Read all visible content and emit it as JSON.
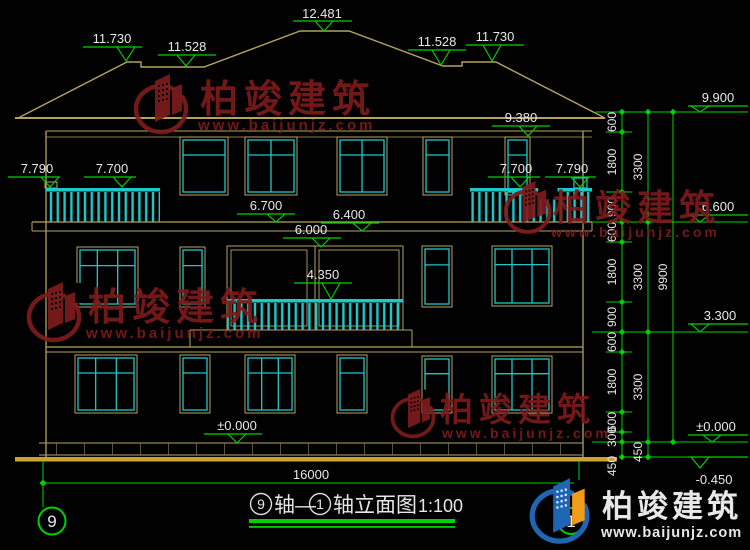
{
  "watermark": {
    "brand": "柏竣建筑",
    "url": "www.baijunjz.com"
  },
  "logo": {
    "brand": "柏竣建筑",
    "url": "www.baijunjz.com"
  },
  "title": {
    "axis_start": "9",
    "segment1": "轴—",
    "axis_end": "1",
    "segment2": "轴立面图",
    "scale": "1:100"
  },
  "axis_bubbles": {
    "left": "9",
    "right": "1"
  },
  "bottom_dimension": {
    "total_width": "16000"
  },
  "elevation_markers": [
    {
      "id": "ridge-main",
      "label": "12.481"
    },
    {
      "id": "ridge-left-high",
      "label": "11.730"
    },
    {
      "id": "ridge-left-low",
      "label": "11.528"
    },
    {
      "id": "ridge-right-low",
      "label": "11.528"
    },
    {
      "id": "ridge-right-high",
      "label": "11.730"
    },
    {
      "id": "eave-fascia",
      "label": "9.380"
    },
    {
      "id": "right-chain-top",
      "label": "9.900"
    },
    {
      "id": "balcony3f-left-post",
      "label": "7.790"
    },
    {
      "id": "balcony3f-left-rail",
      "label": "7.700"
    },
    {
      "id": "balcony3f-right-rail",
      "label": "7.700"
    },
    {
      "id": "balcony3f-right-post",
      "label": "7.790"
    },
    {
      "id": "cornice-left",
      "label": "6.700"
    },
    {
      "id": "cornice-mid",
      "label": "6.400"
    },
    {
      "id": "floor-3f",
      "label": "6.000"
    },
    {
      "id": "right-chain-mid",
      "label": "6.600"
    },
    {
      "id": "balcony2f-rail",
      "label": "4.350"
    },
    {
      "id": "right-chain-2f",
      "label": "3.300"
    },
    {
      "id": "ground-zero",
      "label": "±0.000"
    },
    {
      "id": "right-chain-zero",
      "label": "±0.000"
    },
    {
      "id": "site-level",
      "label": "-0.450"
    }
  ],
  "dim_chain": {
    "inner": [
      "600",
      "1800",
      "900",
      "600",
      "1800",
      "900",
      "600",
      "1800",
      "600",
      "300",
      "450"
    ],
    "middle": [
      "3300",
      "3300",
      "3300",
      "450"
    ],
    "outer": [
      "9900"
    ]
  },
  "colors": {
    "background": "#000000",
    "line_tan": "#b3a264",
    "ground_gold": "#c8a435",
    "window_cyan": "#1ec8c8",
    "dimension_green": "#00d200",
    "text_white": "#e8e8e8",
    "watermark_red": "#7d1b1b",
    "logo_blue": "#1e66b4",
    "logo_orange": "#f09c1a"
  }
}
